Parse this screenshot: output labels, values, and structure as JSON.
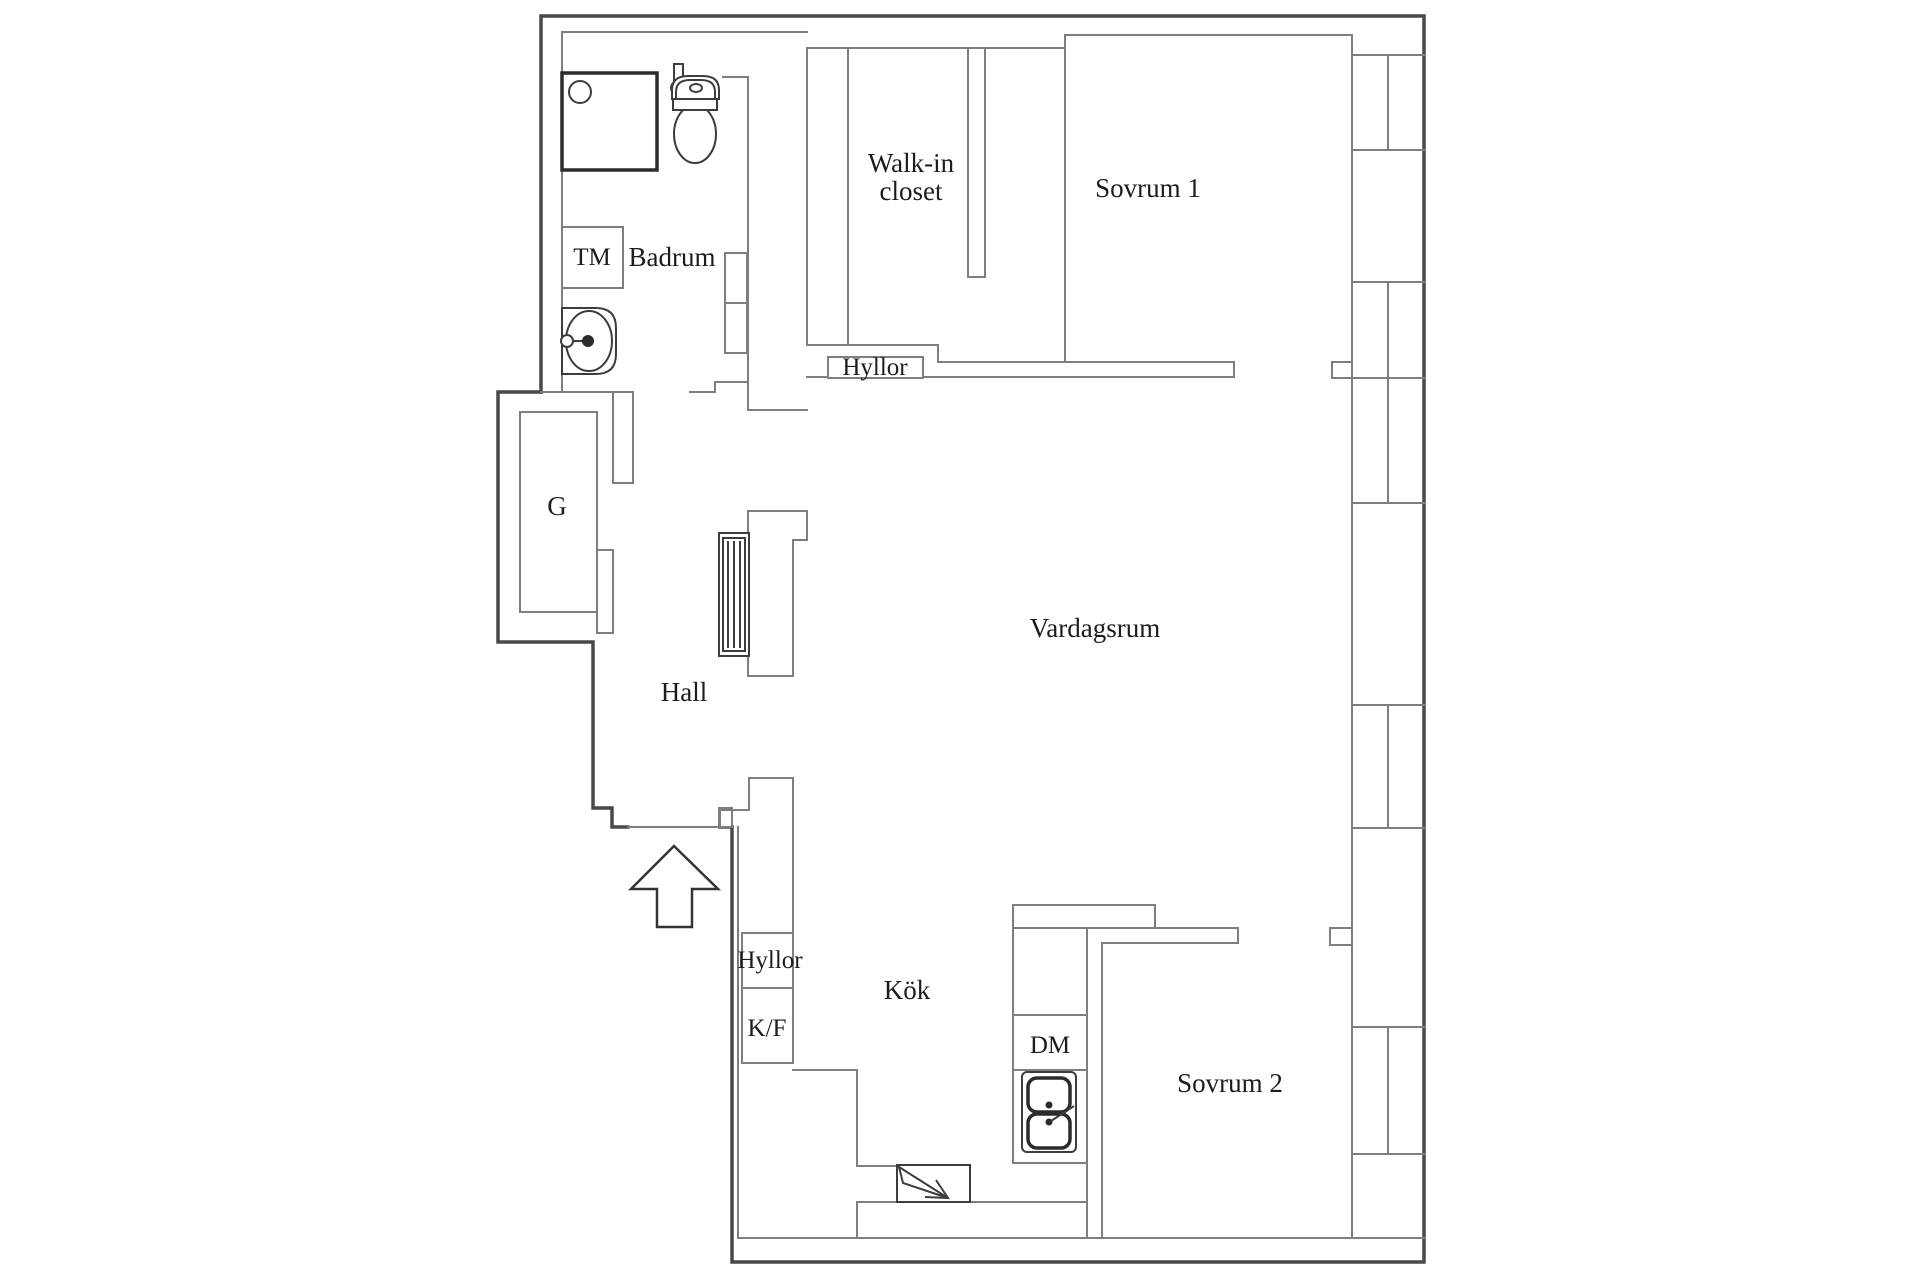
{
  "floorplan": {
    "labels": {
      "badrum": "Badrum",
      "tm": "TM",
      "garderob": "G",
      "hall": "Hall",
      "walk_in_closet_line1": "Walk-in",
      "walk_in_closet_line2": "closet",
      "sovrum_1": "Sovrum 1",
      "vardagsrum": "Vardagsrum",
      "hyllor_closet": "Hyllor",
      "hyllor_kitchen": "Hyllor",
      "kf": "K/F",
      "kok": "Kök",
      "dm": "DM",
      "sovrum_2": "Sovrum 2"
    },
    "colors": {
      "background": "#ffffff",
      "outer_wall": "#484848",
      "inner_wall": "#7e7e7e",
      "fixture_stroke": "#3d3d3d",
      "text": "#1c1c1c"
    },
    "icons": [
      "shower-icon",
      "shower-mixer-icon",
      "toilet-icon",
      "washbasin-icon",
      "washing-machine-icon",
      "radiator-icon",
      "chimney-shaft-icon",
      "fridge-freezer-icon",
      "dishwasher-icon",
      "kitchen-sink-icon",
      "stove-icon",
      "entrance-arrow-icon",
      "window-icon"
    ]
  }
}
